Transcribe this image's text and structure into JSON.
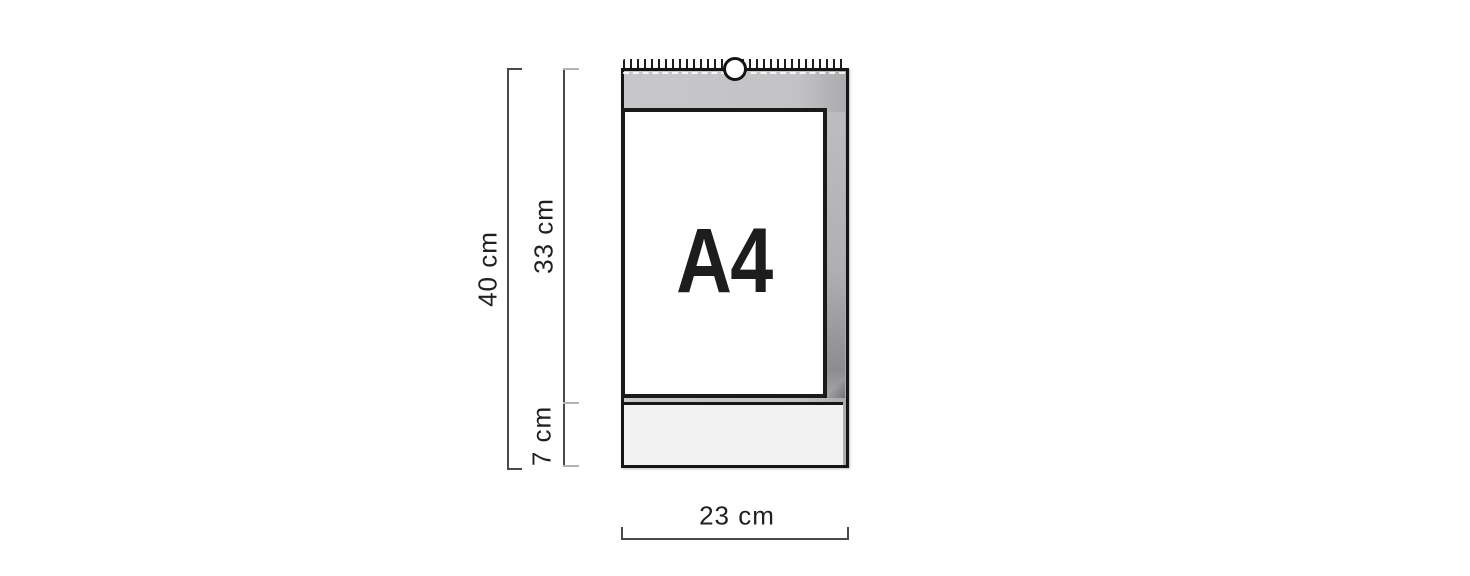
{
  "canvas": {
    "width": 1470,
    "height": 576,
    "background": "#ffffff"
  },
  "diagram": {
    "page_label": "A4",
    "dimensions": {
      "total_height_label": "40 cm",
      "page_height_label": "33 cm",
      "footer_height_label": "7 cm",
      "width_label": "23 cm"
    },
    "icons": {
      "hanger_hook": "circle-ring",
      "spiral_binding": "wire-o-loops"
    },
    "colors": {
      "backing_gray": "#c4c4c6",
      "backing_shadow": "#8d8d8f",
      "footer_bg": "#f2f2f3",
      "page_bg": "#ffffff",
      "outline_black": "#161616",
      "dimension_line": "#4a4a4a",
      "dimension_tick_light": "#b3b3b3",
      "label_text": "#212121"
    }
  }
}
